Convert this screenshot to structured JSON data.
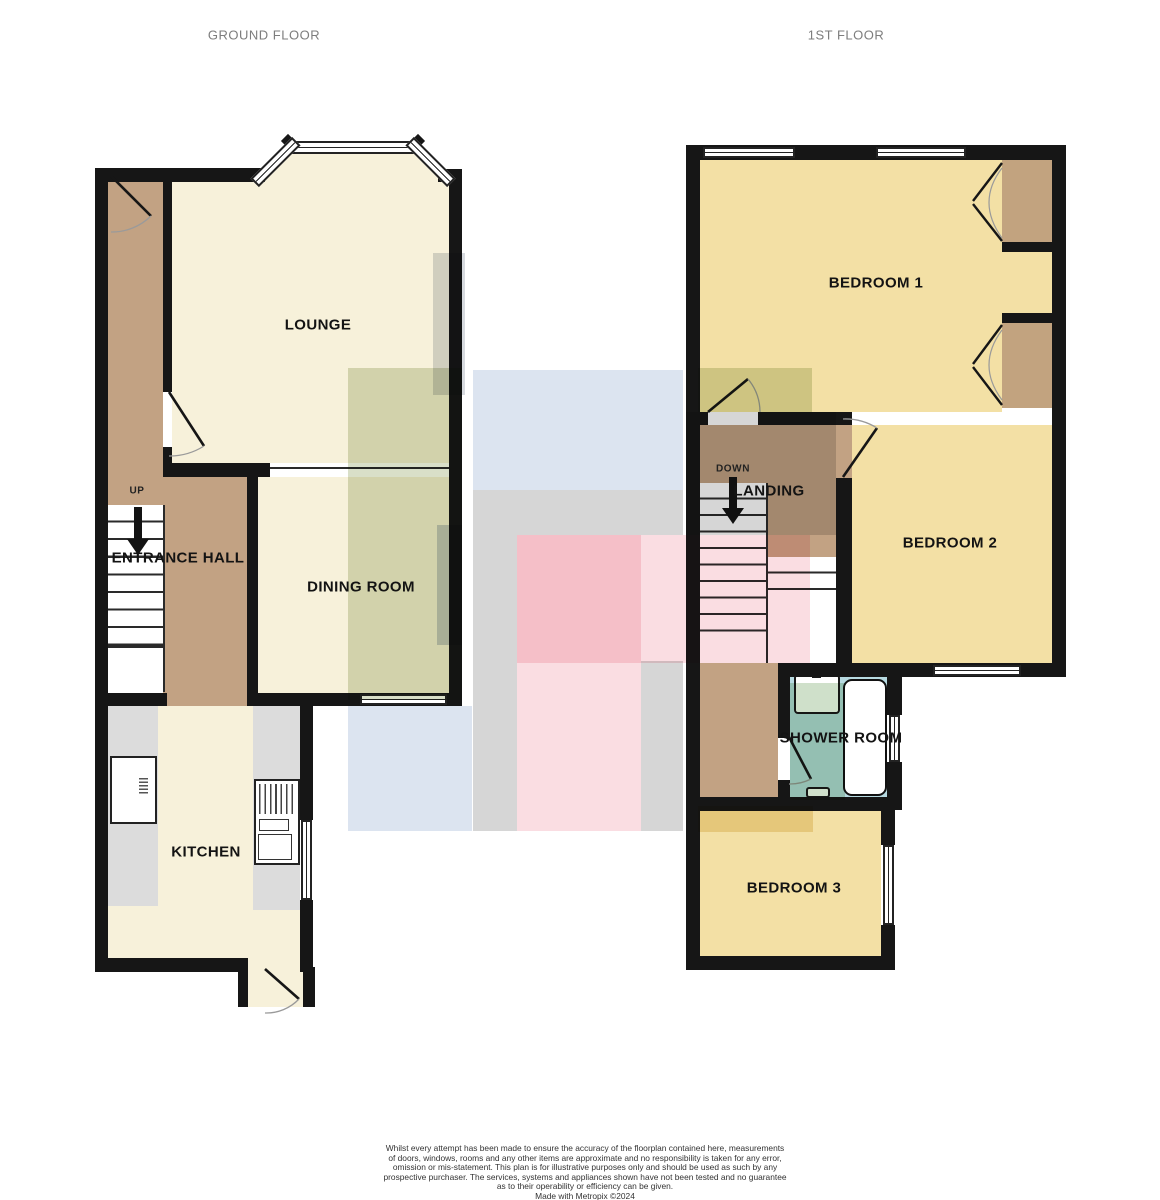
{
  "header": {
    "ground": "GROUND FLOOR",
    "first": "1ST FLOOR"
  },
  "ground_floor": {
    "lounge": "LOUNGE",
    "dining_room": "DINING ROOM",
    "entrance_hall": "ENTRANCE HALL",
    "kitchen": "KITCHEN",
    "stairs_label": "UP"
  },
  "first_floor": {
    "bedroom1": "BEDROOM 1",
    "bedroom2": "BEDROOM 2",
    "bedroom3": "BEDROOM 3",
    "landing": "LANDING",
    "shower_room": "SHOWER ROOM",
    "stairs_label": "DOWN"
  },
  "disclaimer": {
    "lines": [
      "Whilst every attempt has been made to ensure the accuracy of the floorplan contained here, measurements",
      "of doors, windows, rooms and any other items are approximate and no responsibility is taken for any error,",
      "omission or mis-statement. This plan is for illustrative purposes only and should be used as such by any",
      "prospective purchaser. The services, systems and appliances shown have not been tested and no guarantee",
      "as to their operability or efficiency can be given.",
      "Made with Metropix ©2024"
    ]
  },
  "colors": {
    "wall": "#161616",
    "header_text": "#7d7d7d",
    "floor_cream": "#f7f1da",
    "floor_yellow": "#f3e0a5",
    "floor_tan": "#c2a283",
    "floor_wardrobe": "#c2a37f",
    "floor_blue": "#b7dae1",
    "counter_gray": "#dcdcdc",
    "ov_sage": "#d9dfc8",
    "ov_blue": "#dce4f0",
    "ov_gray": "#d6d6d6",
    "ov_pink": "#fadde2",
    "ov_bluegray": "#ccd4e0",
    "ov_graystrip": "#d7dadf",
    "ov_yellow": "#f1e3bd",
    "ov_sage2": "#cfe0ca"
  }
}
